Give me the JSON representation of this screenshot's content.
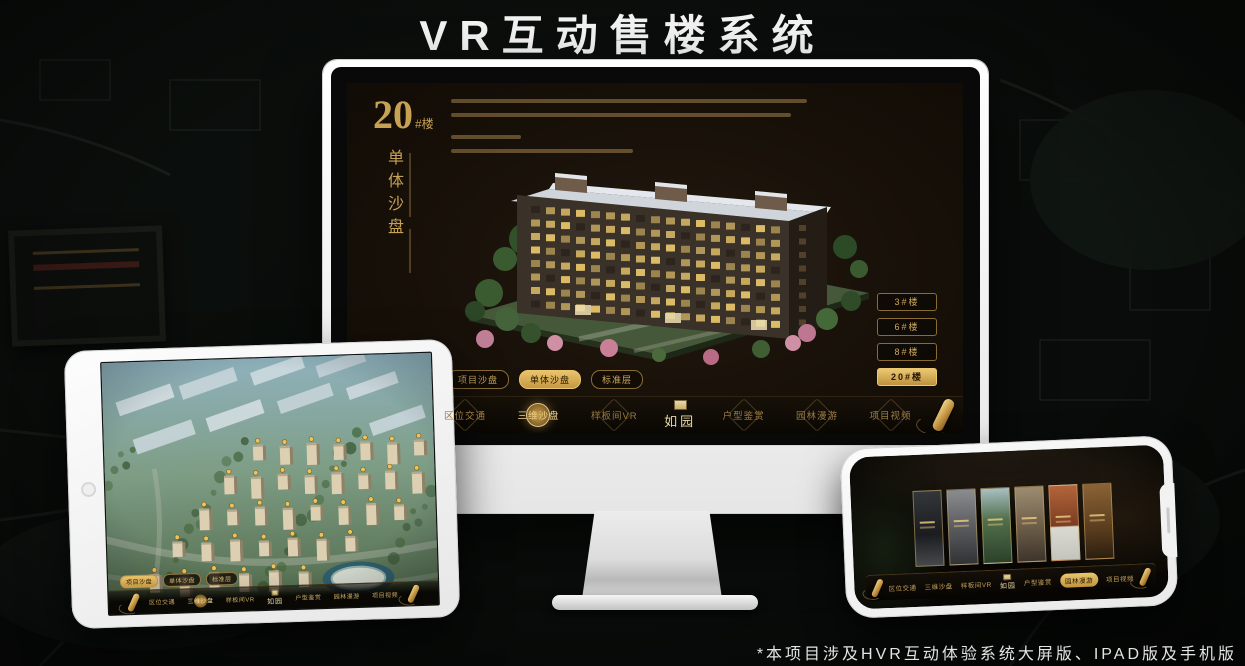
{
  "page": {
    "title": "VR互动售楼系统",
    "footnote": "*本项目涉及HVR互动体验系统大屏版、IPAD版及手机版"
  },
  "brand": {
    "name": "如园"
  },
  "menu": {
    "items": [
      {
        "label": "区位交通"
      },
      {
        "label": "三维沙盘"
      },
      {
        "label": "样板间VR"
      },
      {
        "label": "户型鉴赏"
      },
      {
        "label": "园林漫游"
      },
      {
        "label": "项目视频"
      }
    ]
  },
  "sub_tabs": {
    "items": [
      {
        "label": "项目沙盘"
      },
      {
        "label": "单体沙盘"
      },
      {
        "label": "标准层"
      }
    ]
  },
  "monitor": {
    "heading": {
      "number": "20",
      "suffix": "#楼",
      "vertical": "单体沙盘"
    },
    "active_sub_tab": "单体沙盘",
    "active_menu_item": "三维沙盘",
    "building_buttons": {
      "items": [
        {
          "label": "3#楼"
        },
        {
          "label": "6#楼"
        },
        {
          "label": "8#楼"
        },
        {
          "label": "20#楼"
        }
      ],
      "active": "20#楼"
    }
  },
  "tablet": {
    "active_sub_tab": "项目沙盘",
    "active_menu_item": "三维沙盘"
  },
  "phone": {
    "active_menu_item": "园林漫游"
  },
  "colors": {
    "gold": "#c9a254",
    "gold_bright": "#e9c46c",
    "screen_bg": "#181109"
  }
}
